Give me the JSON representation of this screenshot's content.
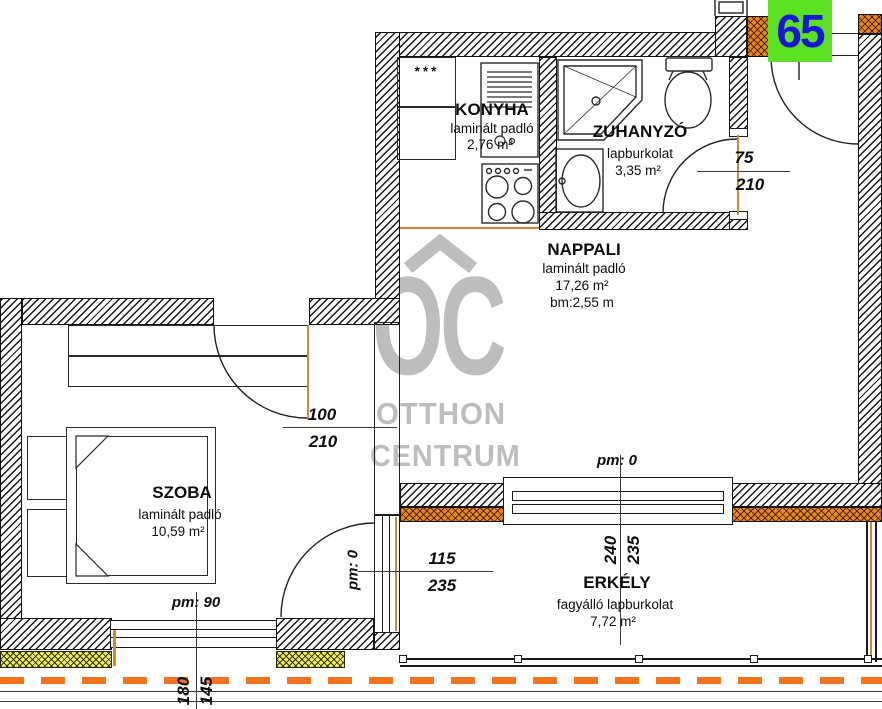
{
  "badge": {
    "number": "65"
  },
  "watermark": {
    "monogram": "OC",
    "line1": "OTTHON",
    "line2": "CENTRUM"
  },
  "rooms": {
    "konyha": {
      "name": "KONYHA",
      "floor": "laminált padló",
      "area": "2,76 m²"
    },
    "zuhanyzo": {
      "name": "ZUHANYZÓ",
      "floor": "lapburkolat",
      "area": "3,35 m²"
    },
    "nappali": {
      "name": "NAPPALI",
      "floor": "laminált padló",
      "area": "17,26 m²",
      "height": "bm:2,55 m"
    },
    "szoba": {
      "name": "SZOBA",
      "floor": "laminált padló",
      "area": "10,59 m²"
    },
    "erkely": {
      "name": "ERKÉLY",
      "floor": "fagyálló lapburkolat",
      "area": "7,72 m²"
    }
  },
  "dimensions": {
    "bath_door": {
      "width": "75",
      "height": "210"
    },
    "szoba_door": {
      "width": "100",
      "height": "210"
    },
    "hall_balcony_door": {
      "width": "115",
      "height": "235",
      "parapet": "pm: 0"
    },
    "nappali_balcony_door": {
      "width": "240",
      "height": "235",
      "parapet": "pm: 0"
    },
    "szoba_window": {
      "width": "180",
      "height": "145",
      "parapet": "pm: 90"
    }
  },
  "symbols": {
    "kitchen_counter": "***"
  },
  "colors": {
    "wall_hatch": "#141414",
    "insulation_orange": "#e8871f",
    "insulation_yellow": "#eef04c",
    "opening_line": "#d28736",
    "terrace_dashed": "#f4731f",
    "badge_bg": "#5ce022",
    "badge_text": "#1a16d8",
    "watermark_gray": "#bdbdbd"
  }
}
